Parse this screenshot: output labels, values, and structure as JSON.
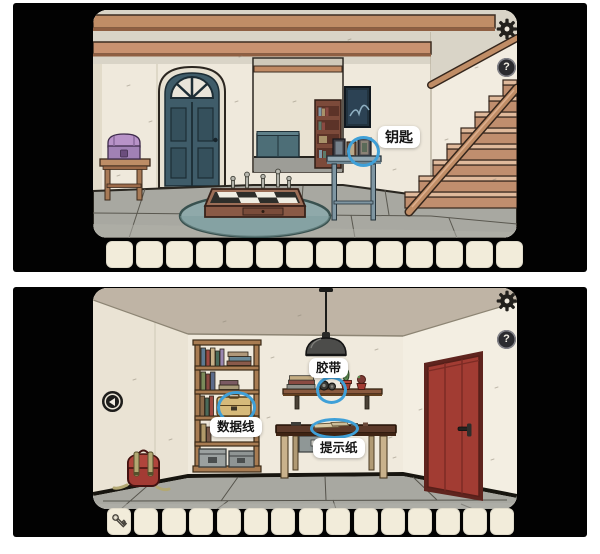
{
  "colors": {
    "page_background": "#ffffff",
    "panel_background": "#020202",
    "slot_background": "#f2ecda",
    "highlight_circle": "#3fa0d8",
    "label_background": "#ffffff",
    "label_text": "#141414"
  },
  "panels": [
    {
      "name": "upper-room-hallway-staircase",
      "help_text": "?",
      "annotations": [
        {
          "text": "钥匙",
          "target": "photo-frame-on-console-table"
        }
      ],
      "inventory": {
        "slot_count": 14,
        "items": []
      }
    },
    {
      "name": "lower-room-basement",
      "help_text": "?",
      "annotations": [
        {
          "text": "胶带",
          "target": "tape-rolls-on-wall-shelf"
        },
        {
          "text": "数据线",
          "target": "case-on-bookshelf"
        },
        {
          "text": "提示纸",
          "target": "papers-on-desk"
        }
      ],
      "inventory": {
        "slot_count": 15,
        "items": [
          {
            "slot": 0,
            "name": "key"
          }
        ]
      }
    }
  ]
}
